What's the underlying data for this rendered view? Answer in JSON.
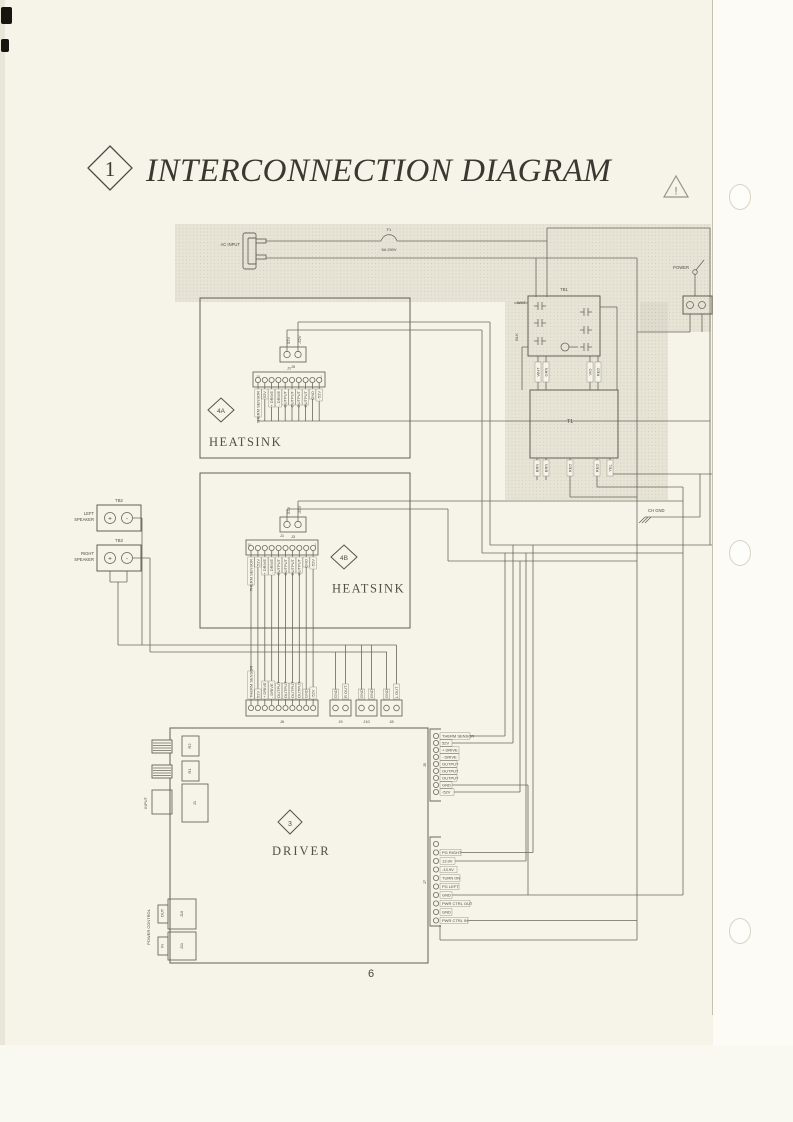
{
  "page": {
    "number": "6"
  },
  "title": {
    "badge": "1",
    "text": "INTERCONNECTION DIAGRAM",
    "warning": "!"
  },
  "power_input": {
    "ac_label": "AC INPUT",
    "fuse_name": "F1",
    "fuse_rating": "5A 250V",
    "power_label": "POWER"
  },
  "tb1": {
    "label": "TB1",
    "wht": "WHT",
    "blk": "BLK",
    "wires": [
      "WHT",
      "GRN",
      "VIO",
      "RED"
    ]
  },
  "t1": {
    "label": "T1",
    "wires": [
      "BRN",
      "BRN",
      "RED",
      "RED",
      "YEL"
    ]
  },
  "ch_gnd": {
    "label": "CH GND"
  },
  "colors": {
    "paper": "#f6f4e9",
    "line": "#6b675c",
    "shade": "#d7d3c4"
  },
  "heatsink_a": {
    "badge": "4A",
    "title": "HEATSINK",
    "j5": {
      "label": "J5",
      "pins": [
        "52V",
        "-52V"
      ]
    },
    "j1": {
      "label": "J1",
      "pin_left": "10",
      "pin_right": "1",
      "pins": [
        "THERM SENSOR",
        "52V",
        "+ DRIVE",
        "- DRIVE",
        "OUTPUT",
        "OUTPUT",
        "OUTPUT",
        "OUTPUT",
        "GND",
        "-52V"
      ]
    }
  },
  "heatsink_b": {
    "badge": "4B",
    "title": "HEATSINK",
    "j3": {
      "label": "J3",
      "pins": [
        "52V",
        "-52V"
      ]
    },
    "j1": {
      "label": "J1",
      "pin_left": "10",
      "pin_right": "1",
      "pins": [
        "THERM SENSOR",
        "52V",
        "+ DRIVE",
        "- DRIVE",
        "OUTPUT",
        "OUTPUT",
        "OUTPUT",
        "OUTPUT",
        "GND",
        "-52V"
      ]
    }
  },
  "speakers": {
    "tb2_label": "TB2",
    "left_line1": "LEFT",
    "left_line2": "SPEAKER",
    "tb3_label": "TB3",
    "right_line1": "RIGHT",
    "right_line2": "SPEAKER",
    "plus": "+",
    "minus": "-"
  },
  "driver": {
    "badge": "3",
    "title": "DRIVER",
    "r2": "R2",
    "r1": "R1",
    "input_label": "INPUT",
    "input_conn": "J1",
    "power_control": "POWER CONTROL",
    "out_label": "OUT",
    "out_conn": "J10",
    "in_label": "IN",
    "in_conn": "J11",
    "j6": {
      "label": "J6",
      "pins": [
        "THERM SENSOR",
        "52V",
        "+ DRIVE",
        "- DRIVE",
        "OUTPUT",
        "OUTPUT",
        "OUTPUT",
        "OUTPUT",
        "GND",
        "-52V"
      ]
    },
    "j9": {
      "label": "J9",
      "pins": [
        "GND",
        "R OUT"
      ]
    },
    "j10": {
      "label": "J10",
      "pins": [
        "GND",
        "GND"
      ]
    },
    "j8": {
      "label": "J8",
      "pins": [
        "GND",
        "L OUT"
      ]
    },
    "j5": {
      "label": "J5",
      "pins": [
        "THERM SENSOR",
        "52V",
        "+ DRIVE",
        "- DRIVE",
        "OUTPUT",
        "OUTPUT",
        "OUTPUT",
        "GND",
        "-52V"
      ]
    },
    "j7": {
      "label": "J7",
      "pins": [
        "PG RIGHT",
        "13.9V",
        "-13.9V",
        "TURN ON",
        "PG LEFT",
        "GND",
        "PWR CTRL OUT",
        "GND",
        "PWR CTRL IN"
      ]
    }
  }
}
